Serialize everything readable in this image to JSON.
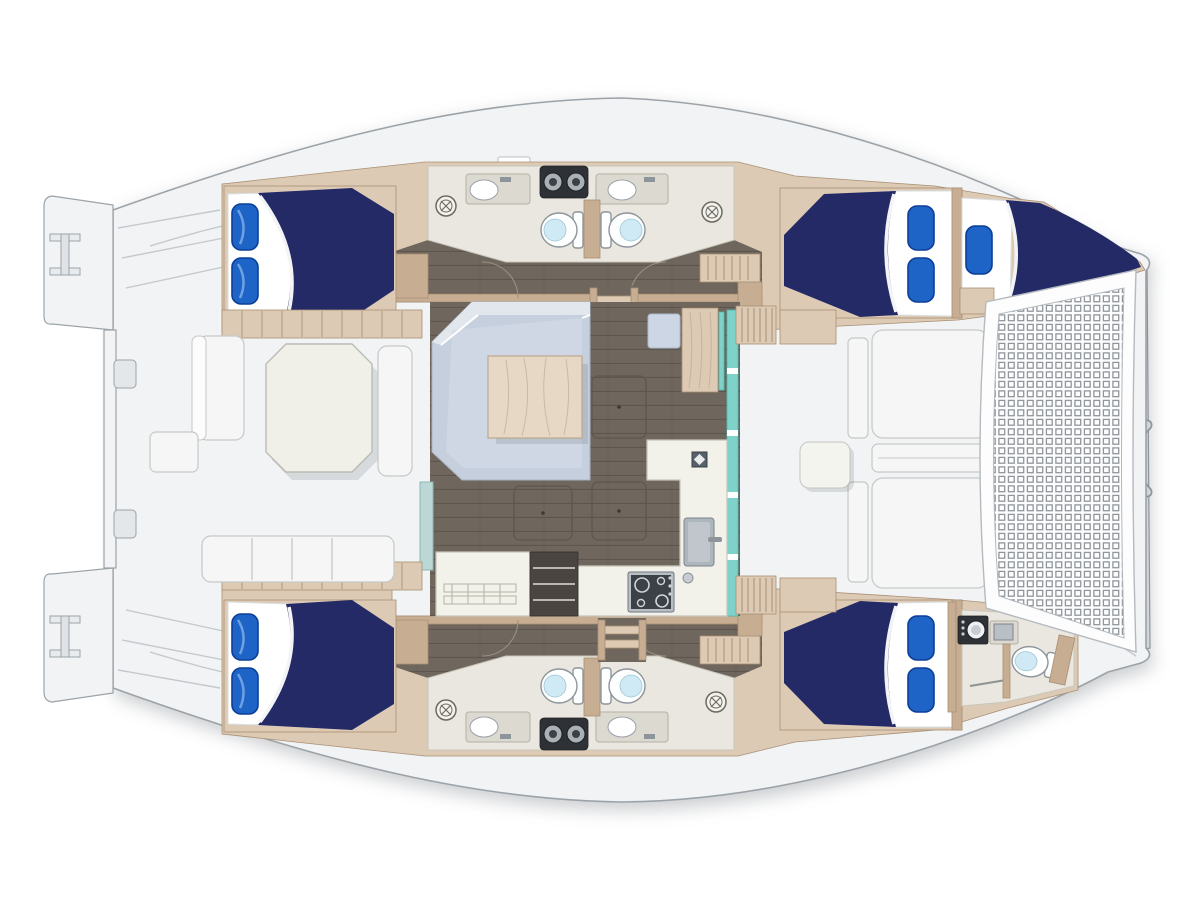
{
  "floorplan": {
    "subject": "catamaran-yacht-floor-plan",
    "view": "Top-down catamaran accommodation and deck plan with four double cabins, one forepeak berth, five toilets, saloon, galley, cockpit and bow trampoline",
    "features": {
      "double_berths": 4,
      "single_forepeak_berths": 1,
      "blue_pillows": 9,
      "toilets": 5,
      "shower_drains": 4,
      "sinks": 6,
      "galley_stove_burners": 4,
      "saloon_tables": 1,
      "cockpit_tables": 2,
      "trampoline_nets": 1,
      "boarding_ladders": 2
    }
  },
  "colors": {
    "background": "#ffffff",
    "hull_fill": "#f1f3f4",
    "hull_stroke": "#9ba3a9",
    "deck_line": "#c3c9ce",
    "wood_light": "#dccab5",
    "wood_mid": "#c7ae93",
    "wood_dark": "#a98f74",
    "floor_dark": "#6f675e",
    "floor_line": "#5e564e",
    "bath_floor": "#e9e7df",
    "bath_counter": "#dcd9d0",
    "counter_white": "#f2f1ea",
    "bed_navy": "#232a66",
    "pillow_blue": "#1e63c6",
    "pillow_dark": "#0c3f98",
    "sheet_white": "#ffffff",
    "sofa_light": "#e2e7ee",
    "sofa_mid": "#c6cfdd",
    "table_wood": "#e7d8c5",
    "table_line": "#bca88d",
    "glass_teal": "#7fd2ca",
    "appliance_dark": "#2e3236",
    "metal": "#a9b0b6",
    "toilet_lid": "#cfeaf4",
    "net_line": "#8f969c",
    "seat_blue": "#ccd6e4",
    "shelf_dark": "#4a4540"
  }
}
